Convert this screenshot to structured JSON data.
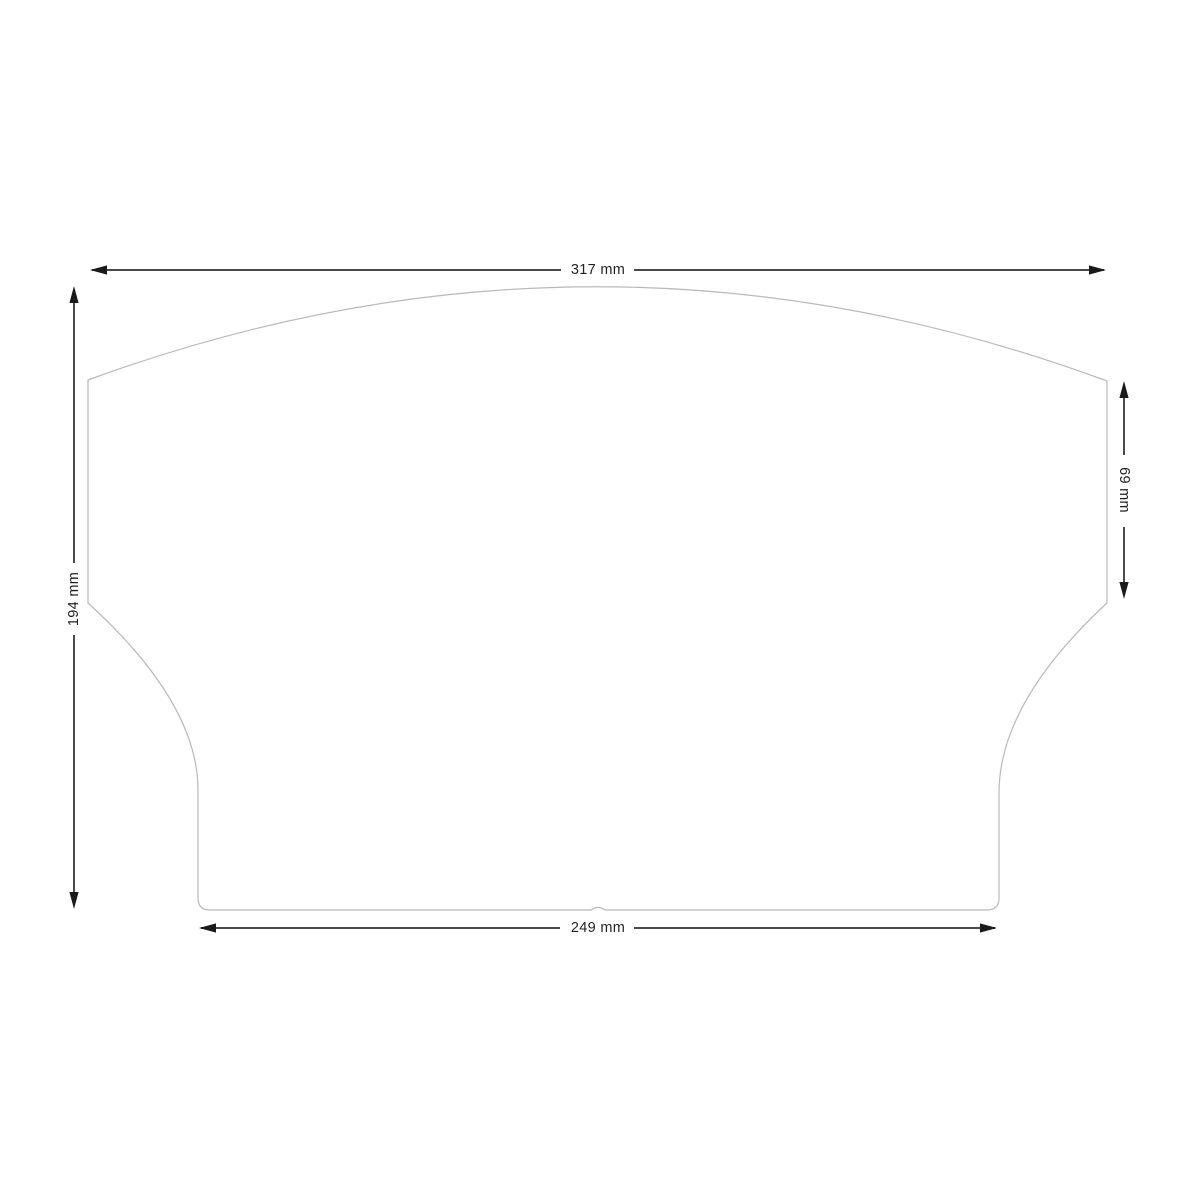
{
  "diagram": {
    "dimensions": {
      "top": "317 mm",
      "left": "194 mm",
      "right": "69 mm",
      "bottom": "249 mm"
    },
    "colors": {
      "background": "#ffffff",
      "outline": "#b9b9b9",
      "dimension_line": "#4a4a4a",
      "arrowhead": "#1a1a1a",
      "text": "#231f20"
    }
  }
}
